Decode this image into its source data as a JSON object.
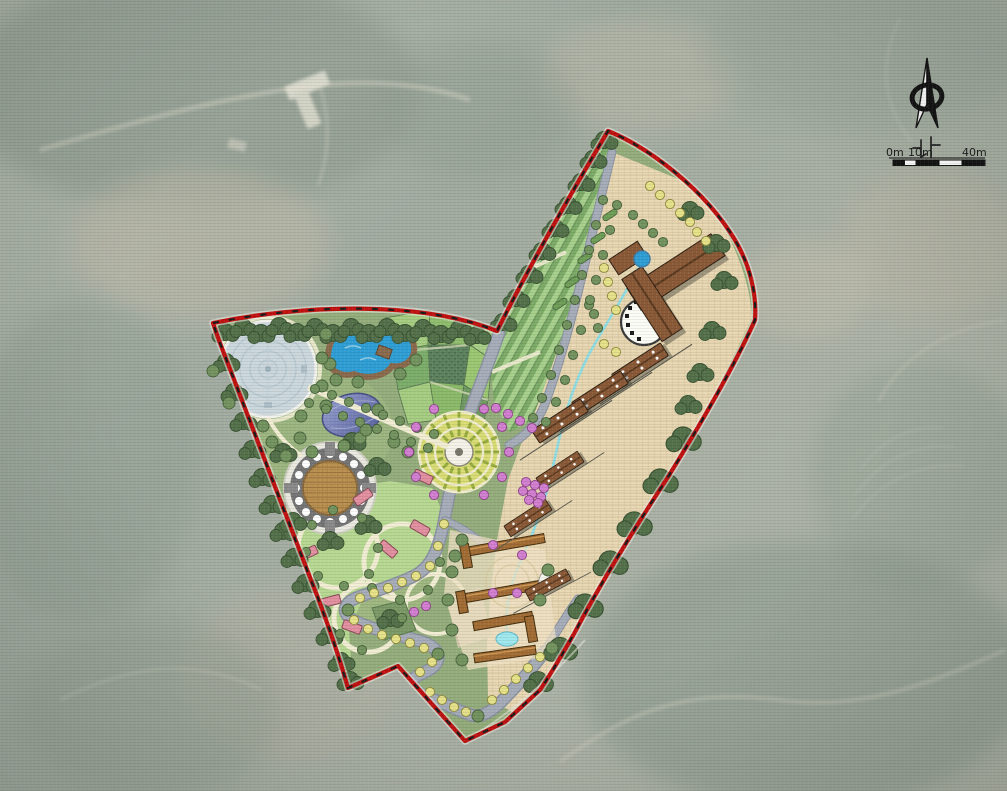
{
  "compass": {
    "label": "北"
  },
  "scale_bar": {
    "label_0": "0m",
    "label_10": "10m",
    "label_40": "40m"
  },
  "colors": {
    "boundary_red": "#c11212",
    "water_blue": "#2f9ed4",
    "stream_cyan": "#8adde6",
    "road_gray": "#a6adb9",
    "plaza_beige": "#e9d8b4",
    "lawn_green": "#b7d892",
    "ground_green": "#95ad7c",
    "tree_green": "#74945f",
    "tree_dark": "#54714a",
    "tree_yellow": "#e6e28a",
    "tree_magenta": "#d27fd0",
    "building_brown": "#8a5a38",
    "corridor_brown": "#a26c35",
    "field_bright": "#9fd66f",
    "terrace_green": "#7dab68",
    "terrace_stripe": "#a8d08d",
    "plaza_blue": "#ccd8dd",
    "dome_purple": "#7e87ba",
    "arena_tan": "#b9904f",
    "cabin_pink": "#e290a0",
    "sand_cream": "#f1edd3"
  },
  "features": [
    "site-boundary",
    "terraced-fields",
    "crop-fields",
    "circular-plaza",
    "lake",
    "geo-dome",
    "amphitheater",
    "lawn-camp",
    "flower-plaza",
    "visitor-center",
    "guesthouse-rows",
    "courtyard-lodges",
    "loop-road",
    "stream",
    "north-compass",
    "scale-bar"
  ]
}
